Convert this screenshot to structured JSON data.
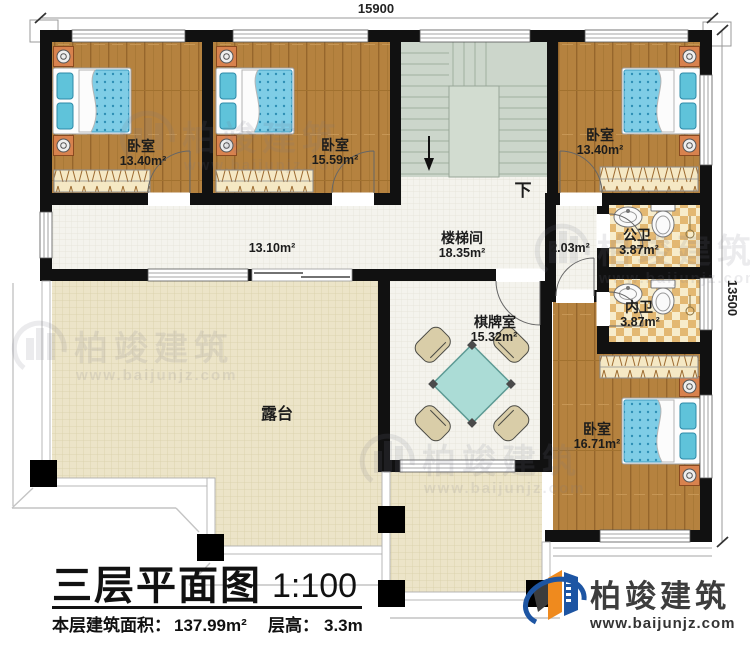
{
  "dimensions": {
    "top": "15900",
    "right": "13500"
  },
  "rooms": {
    "bedroom_tl": {
      "name": "卧室",
      "area": "13.40m²"
    },
    "bedroom_tm": {
      "name": "卧室",
      "area": "15.59m²"
    },
    "bedroom_tr": {
      "name": "卧室",
      "area": "13.40m²"
    },
    "bedroom_br": {
      "name": "卧室",
      "area": "16.71m²"
    },
    "stairwell": {
      "name": "楼梯间",
      "area": "18.35m²",
      "down_label": "下"
    },
    "public_bath": {
      "name": "公卫",
      "area": "3.87m²"
    },
    "inner_bath": {
      "name": "内卫",
      "area": "3.87m²"
    },
    "game_room": {
      "name": "棋牌室",
      "area": "15.32m²"
    },
    "terrace": {
      "name": "露台"
    },
    "corridor": {
      "area": "13.10m²"
    },
    "hall": {
      "area": "2.03m²"
    }
  },
  "title_block": {
    "title": "三层平面图",
    "scale": "1:100",
    "area_label": "本层建筑面积：",
    "area_value": "137.99m²",
    "height_label": "层高：",
    "height_value": "3.3m"
  },
  "branding": {
    "company": "柏竣建筑",
    "website": "www.baijunjz.com"
  },
  "watermark": {
    "company": "柏竣建筑",
    "website": "www.baijunjz.com"
  },
  "colors": {
    "wall": "#111111",
    "wood_floor": "#b5823f",
    "stair": "#ccd6cb",
    "terrace": "#ece4c8",
    "tile": "#f4f3ed",
    "bath_tile": "#e3b872",
    "bed_blue": "#7fcde6",
    "logo_blue": "#1d55a3",
    "logo_orange": "#ef8a1e"
  }
}
